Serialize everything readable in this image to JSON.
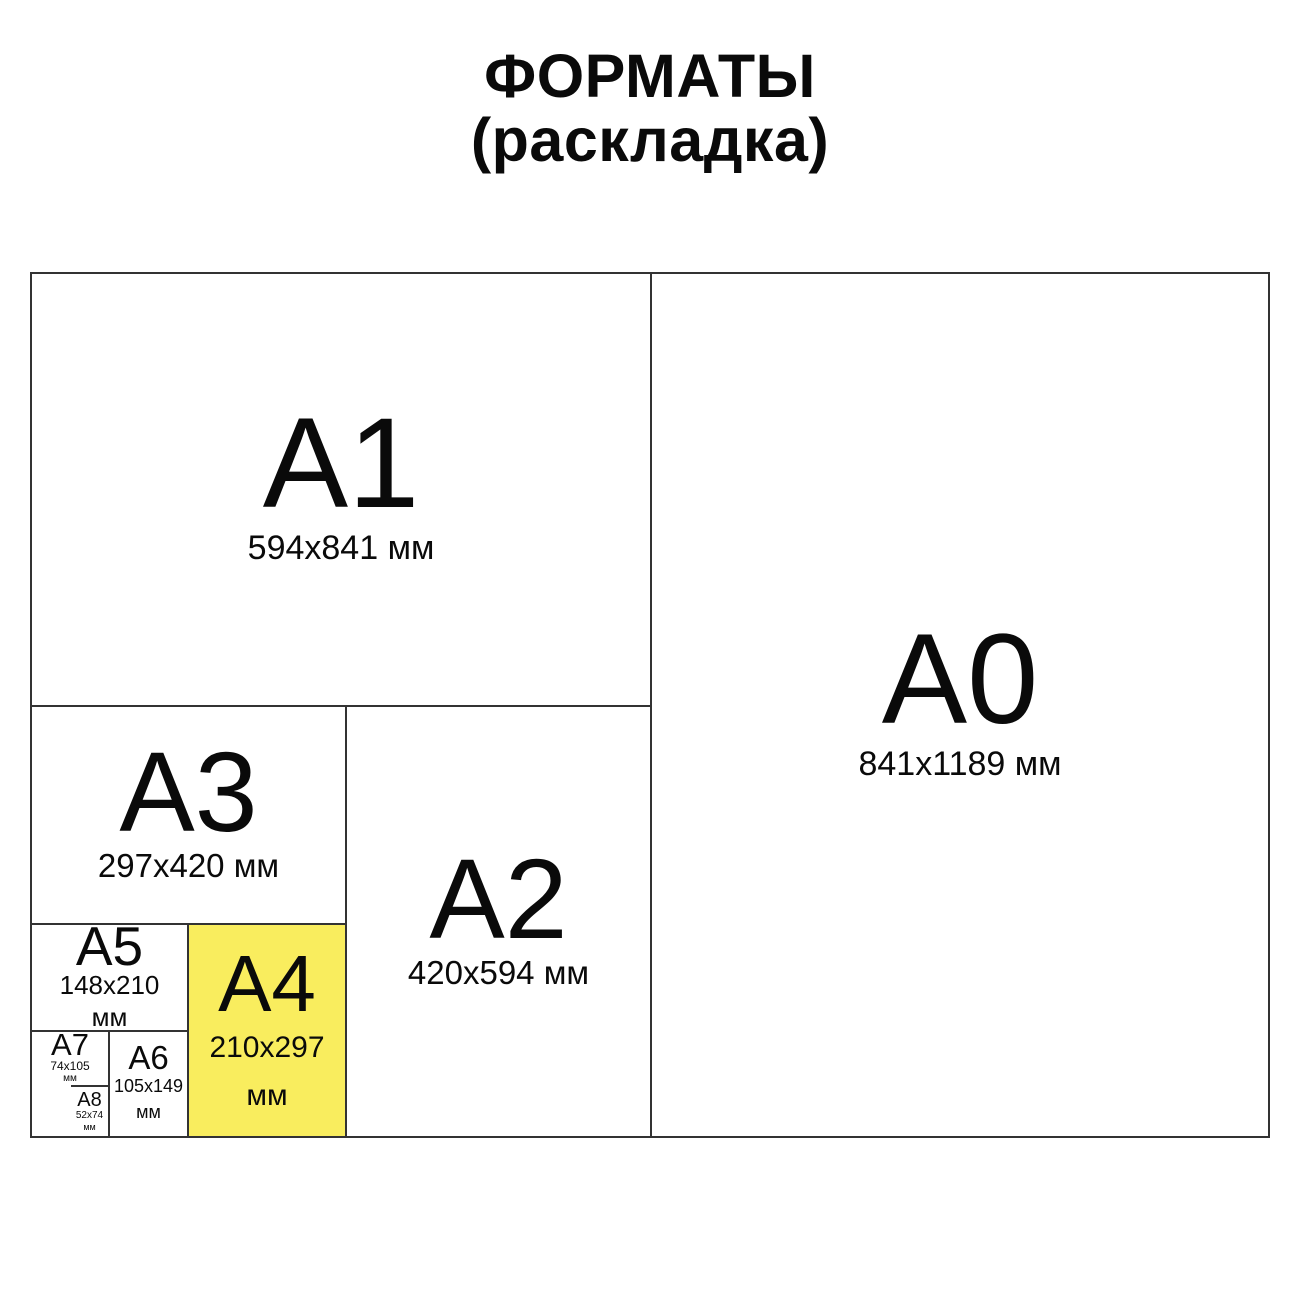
{
  "title": {
    "line1": "ФОРМАТЫ",
    "line2": "(раскладка)"
  },
  "colors": {
    "highlight_yellow": "#f9ed5e",
    "line": "#333333",
    "text": "#0a0a0a",
    "background": "#ffffff"
  },
  "formats": [
    {
      "id": "A1",
      "label": "A1",
      "dims": [
        "594x841 мм"
      ],
      "highlighted": false
    },
    {
      "id": "A0",
      "label": "A0",
      "dims": [
        "841x1189 мм"
      ],
      "highlighted": false
    },
    {
      "id": "A3",
      "label": "A3",
      "dims": [
        "297x420 мм"
      ],
      "highlighted": false
    },
    {
      "id": "A2",
      "label": "A2",
      "dims": [
        "420x594 мм"
      ],
      "highlighted": false
    },
    {
      "id": "A5",
      "label": "A5",
      "dims": [
        "148x210",
        "мм"
      ],
      "highlighted": false
    },
    {
      "id": "A4",
      "label": "A4",
      "dims": [
        "210x297",
        "мм"
      ],
      "highlighted": true
    },
    {
      "id": "A7",
      "label": "A7",
      "dims": [
        "74x105",
        "мм"
      ],
      "highlighted": false
    },
    {
      "id": "A6",
      "label": "A6",
      "dims": [
        "105x149",
        "мм"
      ],
      "highlighted": false
    },
    {
      "id": "A8",
      "label": "A8",
      "dims": [
        "52x74",
        "мм"
      ],
      "highlighted": false
    }
  ]
}
